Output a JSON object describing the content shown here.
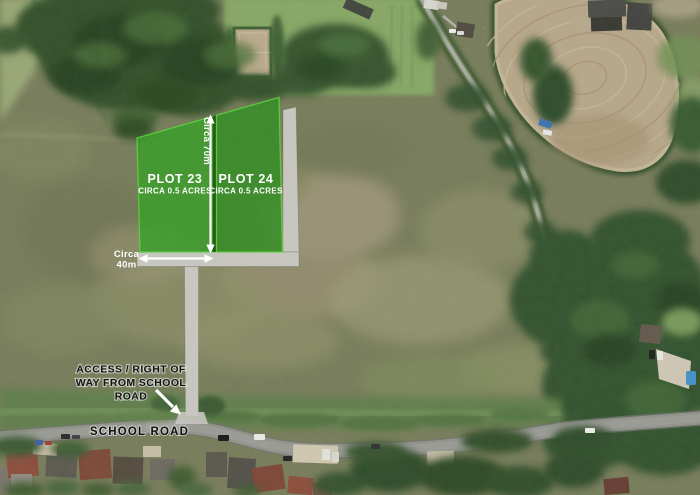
{
  "map": {
    "plots": [
      {
        "name": "PLOT 23",
        "area": "CIRCA 0.5 ACRES"
      },
      {
        "name": "PLOT 24",
        "area": "CIRCA 0.5 ACRES"
      }
    ],
    "measurements": {
      "depth": "Circa 70m",
      "width_line1": "Circa",
      "width_line2": "40m"
    },
    "access_note": {
      "line1": "ACCESS / RIGHT OF",
      "line2": "WAY FROM SCHOOL",
      "line3": "ROAD"
    },
    "road_label": "SCHOOL ROAD",
    "colors": {
      "plot23_fill": "#2f9e1f",
      "plot24_fill": "#2b8c1d",
      "plot_edge": "#56d336",
      "track_gray": "#c8c7c1",
      "arrow_white": "#ffffff",
      "annotation_text": "#141414"
    },
    "icons": {
      "depth_arrow": "double-arrow-vertical-icon",
      "width_arrow": "double-arrow-horizontal-icon",
      "access_arrow": "pointer-arrow-icon"
    }
  }
}
